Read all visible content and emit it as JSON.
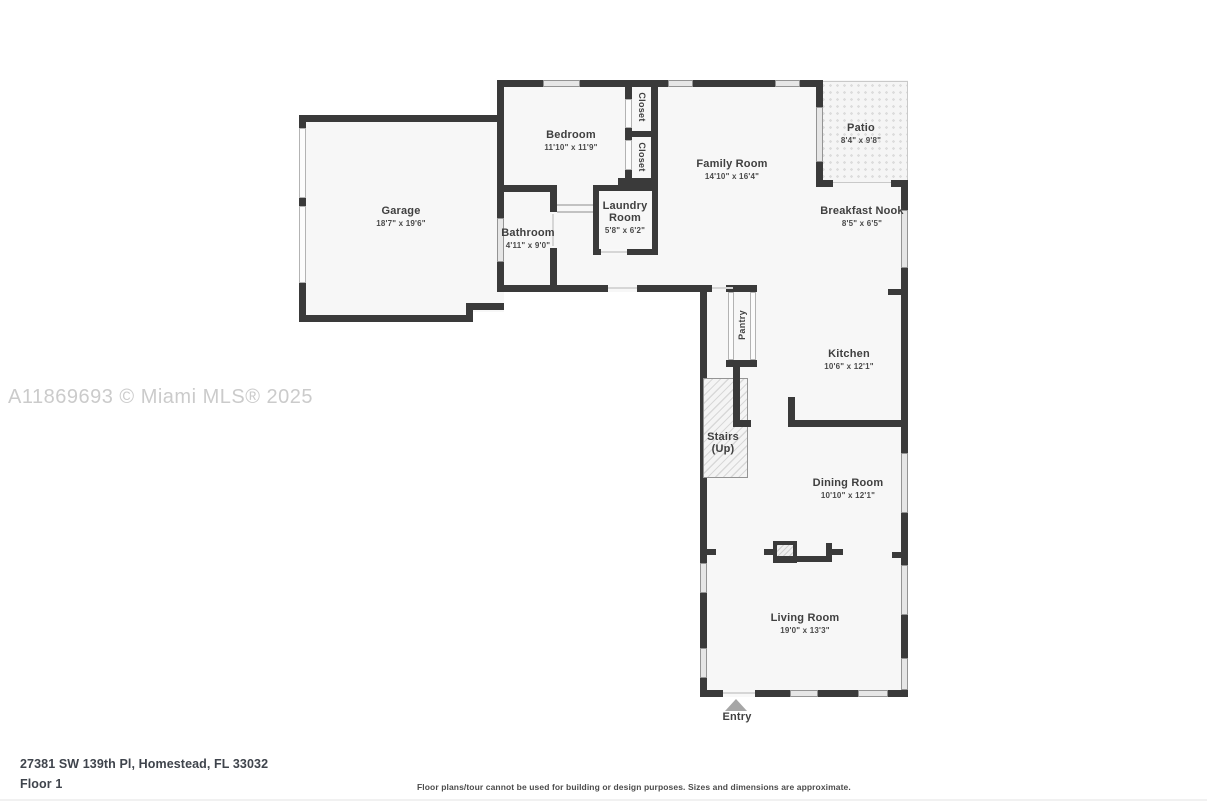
{
  "watermark": "A11869693 © Miami MLS® 2025",
  "footer": {
    "address": "27381 SW 139th Pl, Homestead, FL 33032",
    "floor_label": "Floor 1",
    "disclaimer": "Floor plans/tour cannot be used for building or design purposes. Sizes and dimensions are approximate."
  },
  "rooms": {
    "garage": {
      "name": "Garage",
      "dims": "18'7\" x 19'6\""
    },
    "bedroom": {
      "name": "Bedroom",
      "dims": "11'10\" x 11'9\""
    },
    "closet_upper": {
      "name": "Closet"
    },
    "closet_lower": {
      "name": "Closet"
    },
    "family_room": {
      "name": "Family Room",
      "dims": "14'10\" x 16'4\""
    },
    "patio": {
      "name": "Patio",
      "dims": "8'4\" x 9'8\""
    },
    "breakfast_nook": {
      "name": "Breakfast Nook",
      "dims": "8'5\" x 6'5\""
    },
    "bathroom": {
      "name": "Bathroom",
      "dims": "4'11\" x 9'0\""
    },
    "laundry_room": {
      "line1": "Laundry",
      "line2": "Room",
      "dims": "5'8\" x 6'2\""
    },
    "pantry": {
      "name": "Pantry"
    },
    "kitchen": {
      "name": "Kitchen",
      "dims": "10'6\" x 12'1\""
    },
    "stairs": {
      "line1": "Stairs",
      "line2": "(Up)"
    },
    "dining_room": {
      "name": "Dining Room",
      "dims": "10'10\" x 12'1\""
    },
    "living_room": {
      "name": "Living Room",
      "dims": "19'0\" x 13'3\""
    },
    "entry": {
      "name": "Entry"
    }
  },
  "colors": {
    "wall": "#3a3a3a",
    "floor": "#f7f7f7",
    "window": "#e6e6e6",
    "watermark": "#cbcbcb"
  }
}
